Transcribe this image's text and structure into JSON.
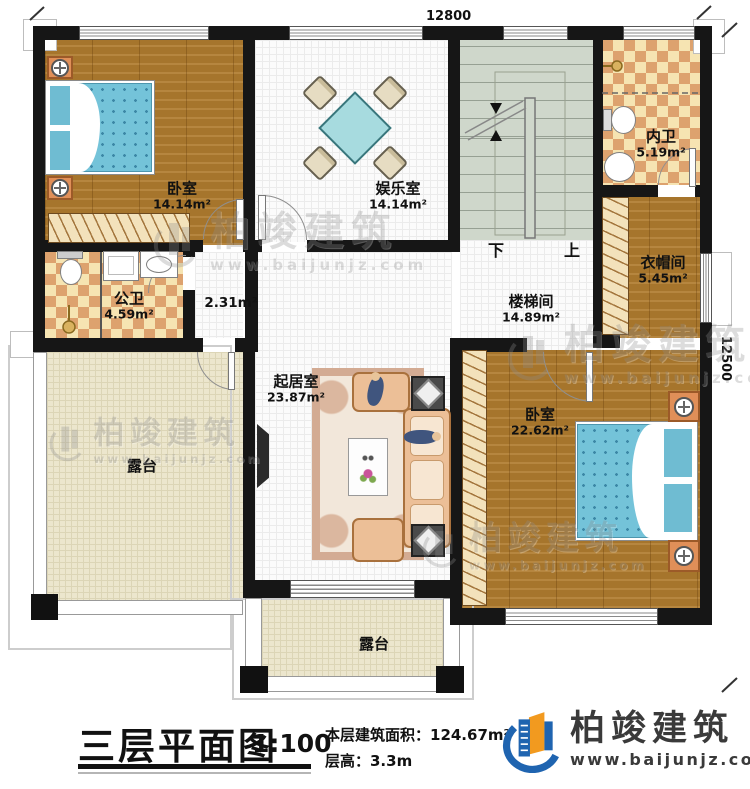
{
  "plan": {
    "dimension_top": "12800",
    "dimension_right": "12500",
    "stair": {
      "down": "下",
      "up": "上"
    },
    "rooms": {
      "bedroom1": {
        "name": "卧室",
        "area": "14.14m²"
      },
      "recreation": {
        "name": "娱乐室",
        "area": "14.14m²"
      },
      "inner_bath": {
        "name": "内卫",
        "area": "5.19m²"
      },
      "cloakroom": {
        "name": "衣帽间",
        "area": "5.45m²"
      },
      "stairwell": {
        "name": "楼梯间",
        "area": "14.89m²"
      },
      "public_bath": {
        "name": "公卫",
        "area": "4.59m²"
      },
      "hallway": {
        "area": "2.31m²"
      },
      "living": {
        "name": "起居室",
        "area": "23.87m²"
      },
      "bedroom2": {
        "name": "卧室",
        "area": "22.62m²"
      },
      "terrace_left": {
        "name": "露台"
      },
      "terrace_bottom": {
        "name": "露台"
      }
    }
  },
  "watermark": {
    "brand": "柏竣建筑",
    "url": "www.baijunjz.com"
  },
  "footer": {
    "title": "三层平面图",
    "scale": "1:100",
    "area_line": "本层建筑面积：124.67m²",
    "height_line": "层高：3.3m",
    "brand": "柏竣建筑",
    "brand_url": "www.baijunjz.com",
    "brand_blue": "#1f64b0",
    "brand_orange": "#f29a1f"
  }
}
